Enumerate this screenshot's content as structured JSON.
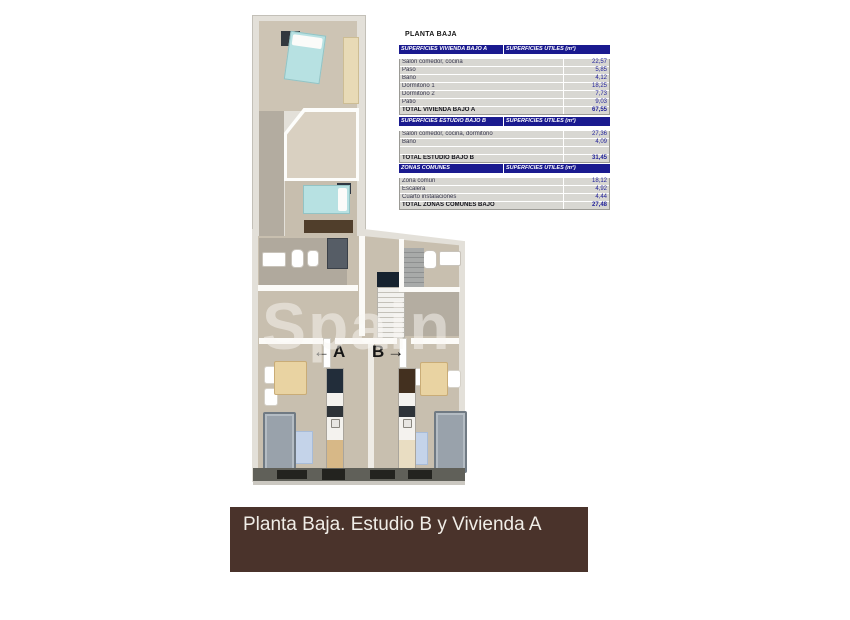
{
  "panel": {
    "title": "PLANTA BAJA",
    "col_header": "SUPERFICIES UTILES  (m²)",
    "tables": [
      {
        "name": "SUPERFICIES VIVIENDA BAJO A",
        "rows": [
          {
            "label": "Salón comedor, cocina",
            "value": "22,57"
          },
          {
            "label": "Paso",
            "value": "5,85"
          },
          {
            "label": "Baño",
            "value": "4,12"
          },
          {
            "label": "Dormitorio 1",
            "value": "18,25"
          },
          {
            "label": "Dormitorio 2",
            "value": "7,73"
          },
          {
            "label": "Patio",
            "value": "9,03"
          }
        ],
        "total": {
          "label": "TOTAL VIVIENDA BAJO A",
          "value": "67,55"
        }
      },
      {
        "name": "SUPERFICIES ESTUDIO BAJO B",
        "rows": [
          {
            "label": "Salón comedor, cocina, dormitorio",
            "value": "27,36"
          },
          {
            "label": "Baño",
            "value": "4,09"
          }
        ],
        "total": {
          "label": "TOTAL ESTUDIO BAJO B",
          "value": "31,45"
        }
      },
      {
        "name": "ZONAS COMUNES",
        "rows": [
          {
            "label": "Zona común",
            "value": "18,12"
          },
          {
            "label": "Escalera",
            "value": "4,92"
          },
          {
            "label": "Cuarto instalaciones",
            "value": "4,44"
          }
        ],
        "total": {
          "label": "TOTAL ZONAS COMUNES BAJO",
          "value": "27,48"
        }
      }
    ]
  },
  "plan": {
    "unit_a_label": "A",
    "unit_b_label": "B",
    "arrow_left": "←",
    "arrow_right": "→",
    "watermark": "Spain"
  },
  "banner": {
    "text": "Planta Baja. Estudio B y Vivienda A"
  },
  "colors": {
    "table_header_bg": "#1a1a8f",
    "table_row_bg": "#d8d7d2",
    "value_text": "#22229a",
    "banner_bg": "#4a332b",
    "bed_teal": "#b7e1e2",
    "rug_blue": "#c4d3e9",
    "sofa_gray": "#99a2ab",
    "kitchen_wood": "#d7b887"
  }
}
